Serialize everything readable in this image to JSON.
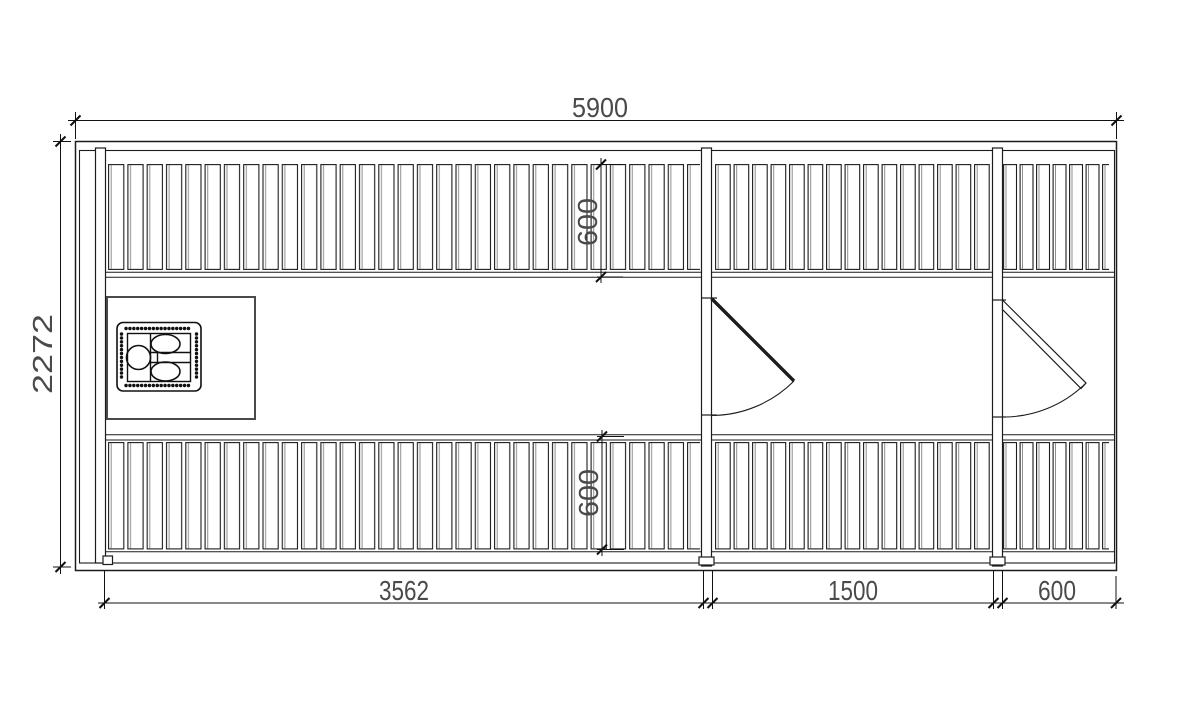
{
  "drawing": {
    "kind": "floor-plan-top-view",
    "dims": {
      "overall_width": "5900",
      "overall_depth": "2272",
      "left_room_width": "3562",
      "middle_room_width": "1500",
      "right_room_width": "600",
      "top_bench_depth": "600",
      "bottom_bench_depth": "600"
    },
    "colors": {
      "line": "#1c1c1c",
      "dim_text": "#4a4a4a",
      "background": "#ffffff"
    }
  }
}
